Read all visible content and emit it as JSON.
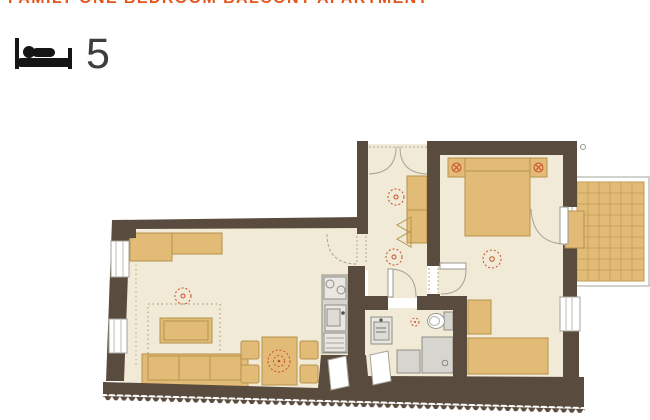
{
  "header": {
    "title": "FAMILY ONE BEDROOM BALCONY APARTMENT",
    "capacity": "5",
    "capacity_icon": "bed-icon"
  },
  "palette": {
    "title_orange": "#E4561D",
    "number_dark": "#3D3D3D",
    "wall_brown": "#5A4B3F",
    "floor_cream": "#F1EAD6",
    "furniture_tan": "#E2BC77",
    "furniture_stroke": "#B5924D",
    "fixture_gray": "#D6D5D0",
    "accent_red": "#C84F2B",
    "balcony_grid": "#C49B55"
  },
  "floor_plan": {
    "rooms": [
      "living-room",
      "kitchen",
      "hallway",
      "bathroom",
      "bedroom",
      "balcony"
    ],
    "feature_icons": [
      "sofa",
      "coffee-table",
      "rug",
      "dining-table",
      "dining-chairs",
      "sideboard",
      "kitchen-counter",
      "cooktop",
      "kitchen-sink",
      "double-bed",
      "nightstands",
      "bed-lamps",
      "wardrobes",
      "desk",
      "bench",
      "bathroom-sink",
      "toilet",
      "shower",
      "washing-machine",
      "ceiling-lights",
      "balcony-grid",
      "entry-door",
      "windows",
      "insulation-hatch"
    ]
  }
}
